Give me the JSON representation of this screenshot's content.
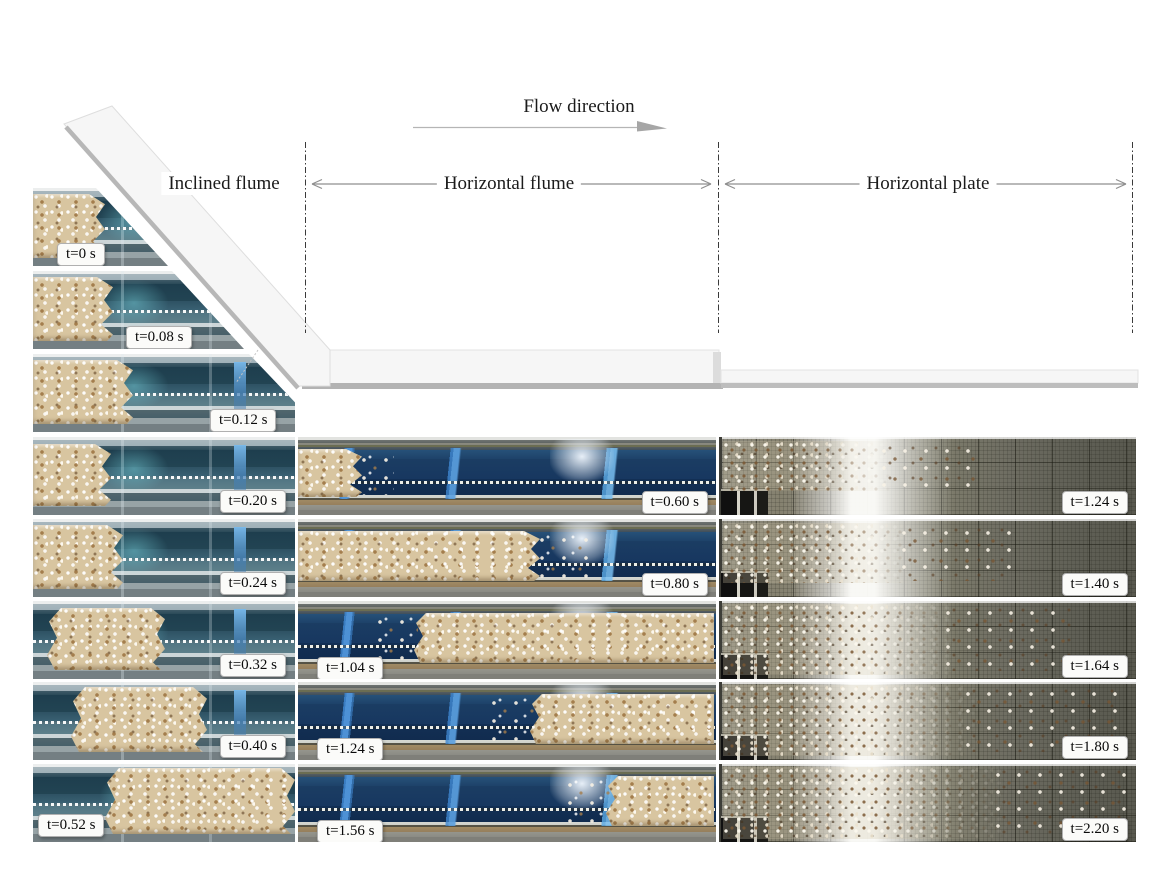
{
  "annotations": {
    "flow_direction": "Flow direction",
    "sections": {
      "inclined": "Inclined flume",
      "flume": "Horizontal flume",
      "plate": "Horizontal plate"
    }
  },
  "frames": {
    "inclined": [
      "t=0 s",
      "t=0.08 s",
      "t=0.12 s",
      "t=0.20 s",
      "t=0.24 s",
      "t=0.32 s",
      "t=0.40 s",
      "t=0.52 s"
    ],
    "horizontal_flume": [
      "t=0.60 s",
      "t=0.80 s",
      "t=1.04 s",
      "t=1.24 s",
      "t=1.56 s"
    ],
    "horizontal_plate": [
      "t=1.24 s",
      "t=1.40 s",
      "t=1.64 s",
      "t=1.80 s",
      "t=2.20 s"
    ]
  },
  "colors": {
    "schematic_fill": "#f6f6f6",
    "schematic_shadow": "#b5b5b5",
    "flume_water_blue": "#173760",
    "stripe_blue": "#3e86d0",
    "grain_tan": "#d8c5a0",
    "plate_grid_gray": "#6e6d62",
    "label_box": "#fbfbf9"
  }
}
